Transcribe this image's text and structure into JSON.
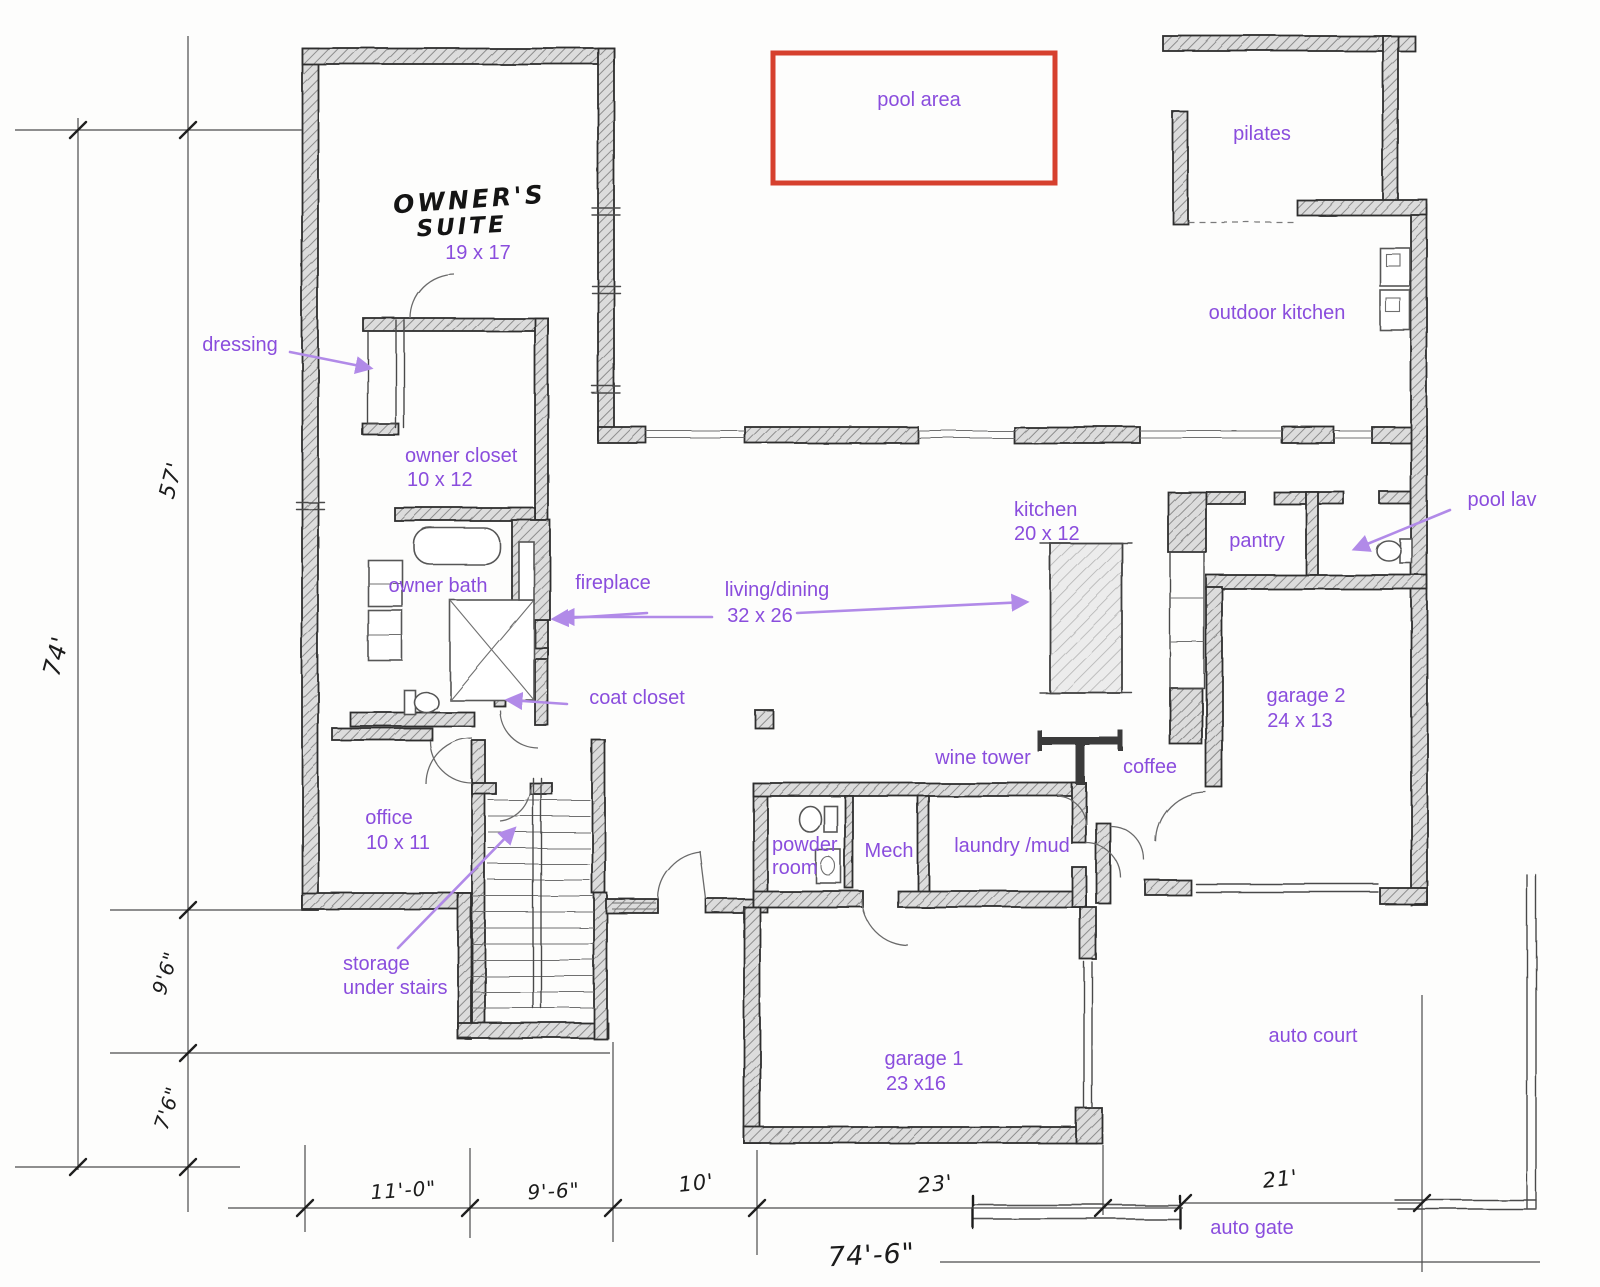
{
  "colors": {
    "label_purple": "#8a4ddd",
    "arrow_purple": "#b18ae8",
    "red_box": "#d6402e",
    "pencil": "#3a3a3a"
  },
  "rooms": {
    "pool_area": {
      "name": "pool area"
    },
    "pilates": {
      "name": "pilates"
    },
    "outdoor_kitchen": {
      "name": "outdoor kitchen"
    },
    "owners_suite": {
      "line1": "OWNER'S",
      "line2": "SUITE",
      "size": "19 x 17"
    },
    "dressing": {
      "name": "dressing"
    },
    "owner_closet": {
      "name": "owner closet",
      "size": "10 x 12"
    },
    "owner_bath": {
      "name": "owner bath"
    },
    "fireplace": {
      "name": "fireplace"
    },
    "living_dining": {
      "name": "living/dining",
      "size": "32 x 26"
    },
    "kitchen": {
      "name": "kitchen",
      "size": "20 x 12"
    },
    "pantry": {
      "name": "pantry"
    },
    "pool_lav": {
      "name": "pool lav"
    },
    "garage_2": {
      "name": "garage 2",
      "size": "24 x 13"
    },
    "coffee": {
      "name": "coffee"
    },
    "wine_tower": {
      "name": "wine tower"
    },
    "coat_closet": {
      "name": "coat closet"
    },
    "office": {
      "name": "office",
      "size": "10 x 11"
    },
    "powder_room": {
      "line1": "powder",
      "line2": "room"
    },
    "mech": {
      "name": "Mech"
    },
    "laundry_mud": {
      "name": "laundry /mud"
    },
    "storage_under_stairs": {
      "line1": "storage",
      "line2": "under stairs"
    },
    "garage_1": {
      "name": "garage 1",
      "size": "23 x16"
    },
    "auto_court": {
      "name": "auto court"
    },
    "auto_gate": {
      "name": "auto gate"
    }
  },
  "dimensions": {
    "left_total": "74'",
    "left_upper": "57'",
    "left_mid": "9'6\"",
    "left_lower": "7'6\"",
    "bottom_1": "11'-0\"",
    "bottom_2": "9'-6\"",
    "bottom_3": "10'",
    "bottom_4": "23'",
    "bottom_5": "21'",
    "bottom_total": "74'-6\""
  }
}
